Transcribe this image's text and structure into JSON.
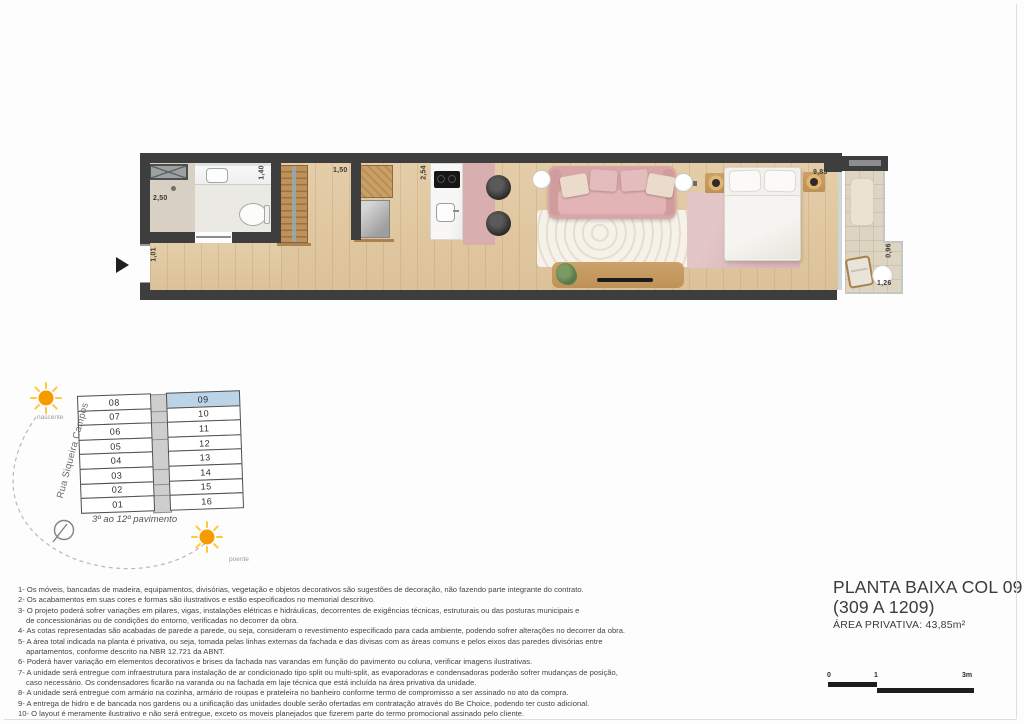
{
  "sheet": {
    "title_line1": "PLANTA BAIXA COL 09",
    "title_line2": "(309 A 1209)",
    "area_label": "ÁREA PRIVATIVA:",
    "area_value": "43,85m²"
  },
  "plan": {
    "dims": {
      "entry": "1,01",
      "shower": "2,50",
      "bath": "1,40",
      "shelf": "1,50",
      "kitchen": "2,54",
      "bedroom": "9,83",
      "balcony_width": "0,96",
      "balcony_depth": "1,26"
    }
  },
  "keyplan": {
    "street": "Rua Siqueira Campos",
    "floors_label": "3º ao 12º pavimento",
    "sun_east_label": "nascente",
    "sun_west_label": "poente",
    "highlighted_unit": "09",
    "rows": [
      {
        "l": "08",
        "r": "09"
      },
      {
        "l": "07",
        "r": "10"
      },
      {
        "l": "06",
        "r": "11"
      },
      {
        "l": "05",
        "r": "12"
      },
      {
        "l": "04",
        "r": "13"
      },
      {
        "l": "03",
        "r": "14"
      },
      {
        "l": "02",
        "r": "15"
      },
      {
        "l": "01",
        "r": "16"
      }
    ]
  },
  "notes": {
    "lines": [
      {
        "text": "1- Os móveis, bancadas de madeira, equipamentos, divisórias, vegetação e objetos decorativos são sugestões de decoração, não fazendo parte integrante do contrato.",
        "indent": false
      },
      {
        "text": "2- Os acabamentos em suas cores e formas são ilustrativos e estão especificados no memorial descritivo.",
        "indent": false
      },
      {
        "text": "3- O projeto poderá sofrer variações em pilares, vigas, instalações elétricas e hidráulicas, decorrentes de exigências técnicas, estruturais ou das posturas municipais e",
        "indent": false
      },
      {
        "text": "de concessionárias ou de condições do entorno, verificadas no decorrer da obra.",
        "indent": true
      },
      {
        "text": "4- As cotas representadas são acabadas de parede a parede, ou seja, consideram o revestimento especificado para cada ambiente, podendo sofrer alterações no decorrer da obra.",
        "indent": false
      },
      {
        "text": "5- A área total indicada na planta é privativa, ou seja, tomada pelas linhas externas da fachada e das divisas com as áreas comuns e pelos eixos das paredes divisórias entre",
        "indent": false
      },
      {
        "text": "apartamentos, conforme descrito na NBR 12.721 da ABNT.",
        "indent": true
      },
      {
        "text": "6- Poderá haver variação em elementos decorativos e brises da fachada nas varandas em função do pavimento ou coluna, verificar imagens ilustrativas.",
        "indent": false
      },
      {
        "text": "7- A unidade será entregue com infraestrutura para instalação de ar condicionado tipo split ou multi-split, as evaporadoras e condensadoras poderão sofrer mudanças de posição,",
        "indent": false
      },
      {
        "text": "caso necessário. Os condensadores ficarão na varanda ou na fachada em laje técnica que está incluída na área privativa da unidade.",
        "indent": true
      },
      {
        "text": "8- A unidade será entregue com armário na cozinha, armário de roupas e prateleira no banheiro conforme termo de compromisso a ser assinado no ato da compra.",
        "indent": false
      },
      {
        "text": "9- A entrega de hidro e de bancada nos gardens ou a unificação das unidades double serão ofertadas em contratação através do Be Choice, podendo ter custo adicional.",
        "indent": false
      },
      {
        "text": "10- O layout é meramente ilustrativo e não será entregue, exceto os moveis planejados que fizerem parte do termo promocional assinado pelo cliente.",
        "indent": false
      }
    ]
  },
  "scalebar": {
    "zero": "0",
    "one": "1",
    "three": "3m"
  },
  "colors": {
    "wall": "#3f3e3e",
    "wood_floor": "#e0c9a4",
    "accent_pink": "#d9aeae",
    "rug_cream": "#ece5d6",
    "rug_pink": "#d8b4b6",
    "unit_highlight": "#bcd4e8",
    "sun_orange": "#f59b00",
    "text_dark": "#3b3b3b"
  }
}
